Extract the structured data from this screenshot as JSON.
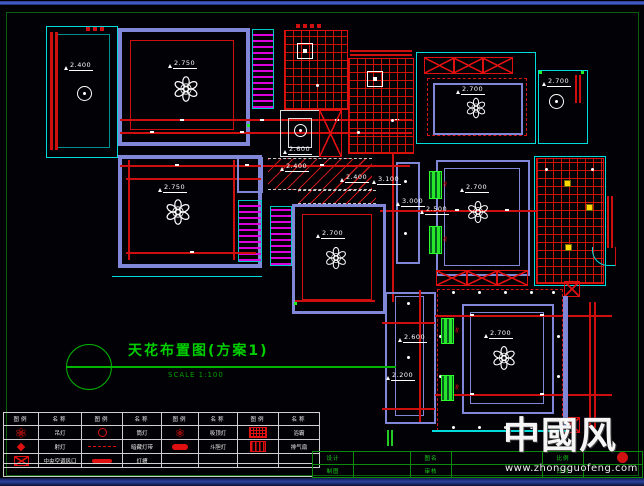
{
  "drawing": {
    "title": "天花布置图(方案1)",
    "scale_note": "SCALE 1:100",
    "levels": {
      "balcony": "2.400",
      "master_bedroom": "2.750",
      "bedroom_left": "2.750",
      "bedroom_top": "2.700",
      "bedroom_mid": "2.700",
      "living": "2.700",
      "dining": "2.700",
      "room_top_right": "2.700",
      "shaft": "2.600",
      "hall_a": "2.400",
      "hall_b": "2.400",
      "corridor_a": "3.100",
      "corridor_b": "3.000",
      "corridor_c": "2.500",
      "corridor_d": "2.600",
      "corridor_e": "2.200"
    }
  },
  "legend": {
    "headers": [
      "图例",
      "名称",
      "图例",
      "名称",
      "图例",
      "名称",
      "图例",
      "名称"
    ],
    "rows": [
      [
        "吊灯",
        "筒灯",
        "吸顶灯",
        "浴霸"
      ],
      [
        "射灯",
        "暗藏灯带",
        "斗胆灯",
        "排气扇"
      ],
      [
        "中央空调风口",
        "灯槽",
        "",
        ""
      ]
    ]
  },
  "titleblock": {
    "rows": [
      [
        "设计",
        "",
        "图名",
        "",
        "比例",
        ""
      ],
      [
        "制图",
        "",
        "审核",
        "",
        "日期",
        ""
      ]
    ]
  },
  "watermark": {
    "brand": "中國风",
    "url": "www.zhongguofeng.com"
  }
}
